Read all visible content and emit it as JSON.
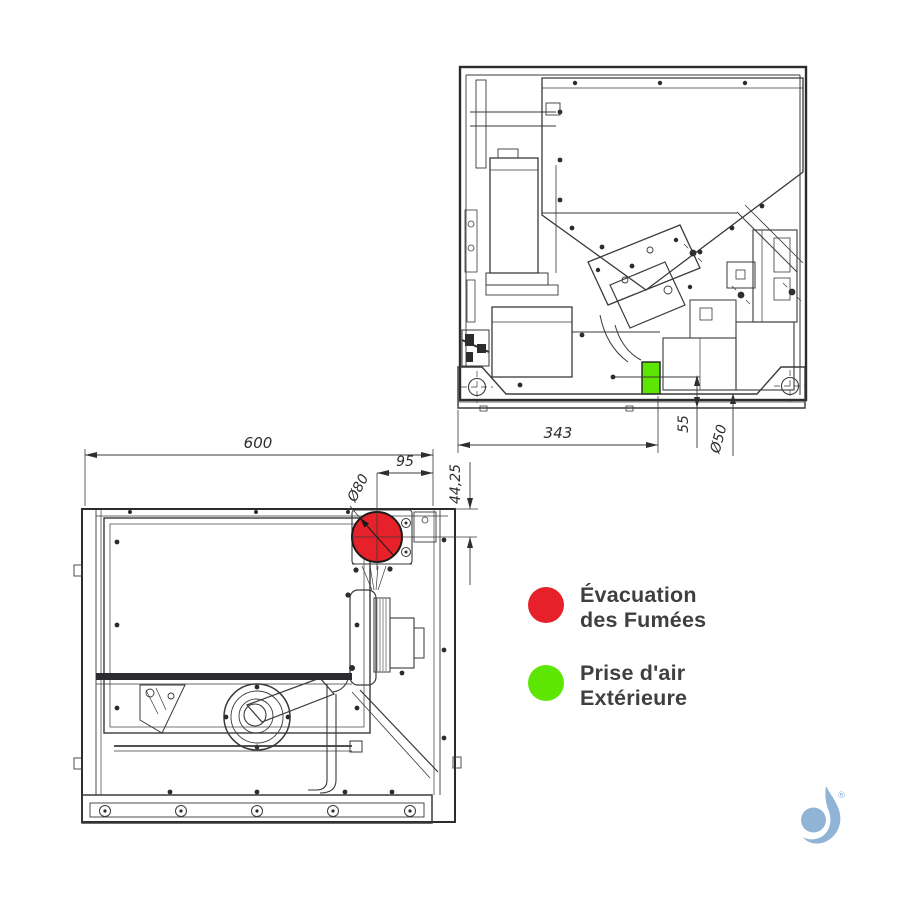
{
  "page": {
    "background": "#ffffff"
  },
  "colors": {
    "line": "#3a3a3a",
    "smoke_red": "#e62129",
    "air_green": "#5ee603",
    "legend_text": "#3f3f41",
    "logo_blue": "#8fb4d6"
  },
  "side_view": {
    "dim_width": "343",
    "dim_offset": "55",
    "dim_intake_diameter": "Ø50"
  },
  "rear_view": {
    "dim_width": "600",
    "dim_flue_offset_x": "95",
    "dim_flue_offset_y": "44,25",
    "dim_flue_diameter": "Ø80"
  },
  "legend": {
    "items": [
      {
        "id": "smoke-evacuation",
        "color": "#e62129",
        "line1": "Évacuation",
        "line2": "des Fumées"
      },
      {
        "id": "outside-air-intake",
        "color": "#5ee603",
        "line1": "Prise d'air",
        "line2": "Extérieure"
      }
    ]
  },
  "logo": {
    "registered": "®"
  }
}
